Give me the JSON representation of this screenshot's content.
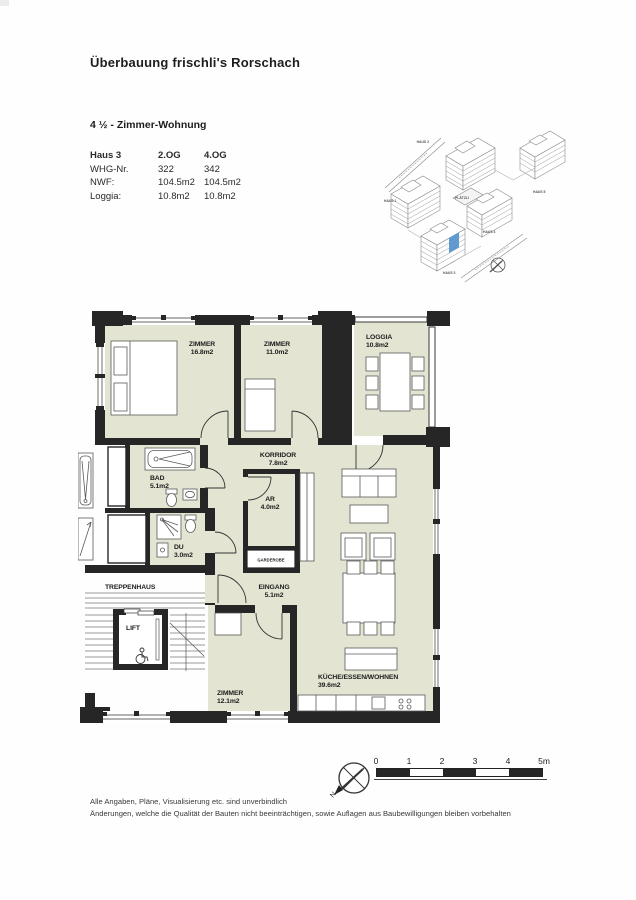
{
  "header": {
    "title": "Überbauung frischli's Rorschach",
    "subtitle": "4 ½ - Zimmer-Wohnung"
  },
  "info_table": {
    "header": {
      "label": "Haus 3",
      "og2": "2.OG",
      "og4": "4.OG"
    },
    "rows": [
      {
        "label": "WHG-Nr.",
        "og2": "322",
        "og4": "342"
      },
      {
        "label": "NWF:",
        "og2": "104.5m2",
        "og4": "104.5m2"
      },
      {
        "label": "Loggia:",
        "og2": "10.8m2",
        "og4": "10.8m2"
      }
    ]
  },
  "site_plan": {
    "labels": {
      "haus1": "HAUS 1",
      "haus2": "HAUS 2",
      "haus3": "HAUS 3",
      "haus4": "HAUS 4",
      "haus5": "HAUS 5",
      "plaetzli": "PLÄTZLI"
    },
    "highlight_color": "#5b9bd5"
  },
  "floor_plan": {
    "colors": {
      "room_fill": "#e3e5d2",
      "wall": "#262626"
    },
    "rooms": {
      "zimmer1": {
        "name": "ZIMMER",
        "area": "16.8m2"
      },
      "zimmer2": {
        "name": "ZIMMER",
        "area": "11.0m2"
      },
      "loggia": {
        "name": "LOGGIA",
        "area": "10.8m2"
      },
      "korridor": {
        "name": "KORRIDOR",
        "area": "7.8m2"
      },
      "bad": {
        "name": "BAD",
        "area": "5.1m2"
      },
      "ar": {
        "name": "AR",
        "area": "4.0m2"
      },
      "garderobe": {
        "name": "GARDEROBE"
      },
      "du": {
        "name": "DU",
        "area": "3.0m2"
      },
      "eingang": {
        "name": "EINGANG",
        "area": "5.1m2"
      },
      "treppenhaus": {
        "name": "TREPPENHAUS"
      },
      "lift": {
        "name": "LIFT"
      },
      "zimmer3": {
        "name": "ZIMMER",
        "area": "12.1m2"
      },
      "kueche": {
        "name": "KÜCHE/ESSEN/WOHNEN",
        "area": "39.6m2"
      }
    }
  },
  "scale_bar": {
    "ticks": [
      "0",
      "1",
      "2",
      "3",
      "4",
      "5m"
    ]
  },
  "compass": {
    "north_label": "N"
  },
  "footer": {
    "line1": "Alle Angaben, Pläne, Visualisierung etc. sind unverbindlich",
    "line2": "Änderungen, welche die Qualität der Bauten nicht beeinträchtigen, sowie Auflagen aus Baubewilligungen bleiben vorbehalten"
  }
}
